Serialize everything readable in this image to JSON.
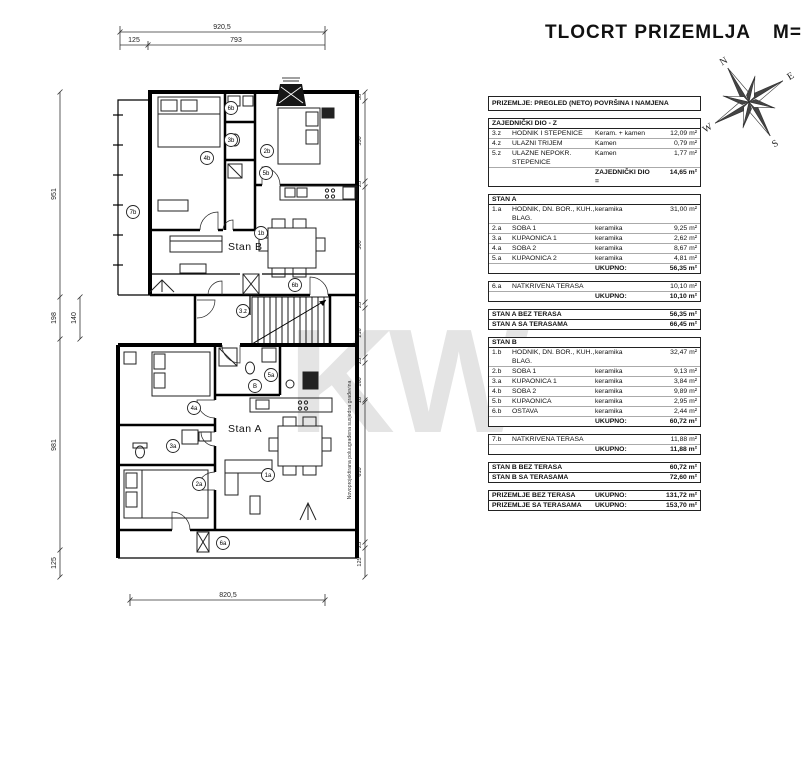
{
  "title": {
    "text": "TLOCRT PRIZEMLJA",
    "scale_label": "M=",
    "scale_value": "1:100"
  },
  "compass": {
    "n": "N",
    "e": "E",
    "s": "S",
    "w": "W"
  },
  "plan": {
    "stan_a_label": "Stan A",
    "stan_b_label": "Stan B",
    "watermark": "KW",
    "registered_mark": "®",
    "side_note": "Novoprojektirana poluugrađena susjedna građevina",
    "circles": {
      "c7b": "7b",
      "c4b": "4b",
      "c6b_top": "6b",
      "c3b": "3b",
      "c2b": "2b",
      "c5b": "5b",
      "c1b": "1b",
      "c6b_bottom": "6b",
      "c3z": "3.z",
      "c5a": "5a",
      "cB": "B",
      "c4a": "4a",
      "c3a": "3a",
      "c2a": "2a",
      "c1a": "1a",
      "c6a": "6a"
    },
    "dims": {
      "top_total": "920,5",
      "top_a": "125",
      "top_b": "793",
      "bottom": "820,5",
      "left_1": "951",
      "left_2": "198",
      "left_sub": "140",
      "left_3": "981",
      "left_4": "125",
      "right_1": "38",
      "right_2": "350",
      "right_3": "25",
      "right_4": "500",
      "right_5": "25",
      "right_6": "216",
      "right_7": "25",
      "right_8": "160",
      "right_9": "10",
      "right_10": "610",
      "right_11": "25",
      "right_12": "125"
    }
  },
  "table": {
    "header": "PRIZEMLJE: PREGLED (NETO) POVRŠINA I NAMJENA",
    "zajednicki": {
      "title": "ZAJEDNIČKI DIO - Z",
      "rows": [
        {
          "id": "3.z",
          "name": "HODNIK I STEPENICE",
          "mat": "Keram. + kamen",
          "val": "12,09 m²"
        },
        {
          "id": "4.z",
          "name": "ULAZNI TRIJEM",
          "mat": "Kamen",
          "val": "0,79 m²"
        },
        {
          "id": "5.z",
          "name": "ULAZNE NEPOKR. STEPENICE",
          "mat": "Kamen",
          "val": "1,77 m²"
        }
      ],
      "total_label": "ZAJEDNIČKI DIO =",
      "total_val": "14,65 m²"
    },
    "stan_a": {
      "title": "STAN A",
      "rows": [
        {
          "id": "1.a",
          "name": "HODNIK, DN. BOR., KUH., BLAG.",
          "mat": "keramika",
          "val": "31,00 m²"
        },
        {
          "id": "2.a",
          "name": "SOBA 1",
          "mat": "keramika",
          "val": "9,25 m²"
        },
        {
          "id": "3.a",
          "name": "KUPAONICA 1",
          "mat": "keramika",
          "val": "2,62 m²"
        },
        {
          "id": "4.a",
          "name": "SOBA 2",
          "mat": "keramika",
          "val": "8,67 m²"
        },
        {
          "id": "5.a",
          "name": "KUPAONICA 2",
          "mat": "keramika",
          "val": "4,81 m²"
        }
      ],
      "total_label": "UKUPNO:",
      "total_val": "56,35 m²"
    },
    "terasa_a": {
      "rows": [
        {
          "id": "6.a",
          "name": "NATKRIVENA TERASA",
          "val": "10,10 m²"
        }
      ],
      "total_label": "UKUPNO:",
      "total_val": "10,10 m²"
    },
    "summary_a": {
      "rows": [
        {
          "name": "STAN A BEZ TERASA",
          "val": "56,35 m²"
        },
        {
          "name": "STAN A SA TERASAMA",
          "val": "66,45 m²"
        }
      ]
    },
    "stan_b": {
      "title": "STAN B",
      "rows": [
        {
          "id": "1.b",
          "name": "HODNIK, DN. BOR., KUH., BLAG.",
          "mat": "keramika",
          "val": "32,47 m²"
        },
        {
          "id": "2.b",
          "name": "SOBA 1",
          "mat": "keramika",
          "val": "9,13 m²"
        },
        {
          "id": "3.a",
          "name": "KUPAONICA 1",
          "mat": "keramika",
          "val": "3,84 m²"
        },
        {
          "id": "4.b",
          "name": "SOBA 2",
          "mat": "keramika",
          "val": "9,89 m²"
        },
        {
          "id": "5.b",
          "name": "KUPAONICA",
          "mat": "keramika",
          "val": "2,95 m²"
        },
        {
          "id": "6.b",
          "name": "OSTAVA",
          "mat": "keramika",
          "val": "2,44 m²"
        }
      ],
      "total_label": "UKUPNO:",
      "total_val": "60,72 m²"
    },
    "terasa_b": {
      "rows": [
        {
          "id": "7.b",
          "name": "NATKRIVENA TERASA",
          "val": "11,88 m²"
        }
      ],
      "total_label": "UKUPNO:",
      "total_val": "11,88 m²"
    },
    "summary_b": {
      "rows": [
        {
          "name": "STAN B BEZ TERASA",
          "val": "60,72 m²"
        },
        {
          "name": "STAN B SA TERASAMA",
          "val": "72,60 m²"
        }
      ]
    },
    "grand": {
      "rows": [
        {
          "name": "PRIZEMLJE BEZ TERASA",
          "label": "UKUPNO:",
          "val": "131,72 m²"
        },
        {
          "name": "PRIZEMLJE SA TERASAMA",
          "label": "UKUPNO:",
          "val": "153,70 m²"
        }
      ]
    }
  }
}
